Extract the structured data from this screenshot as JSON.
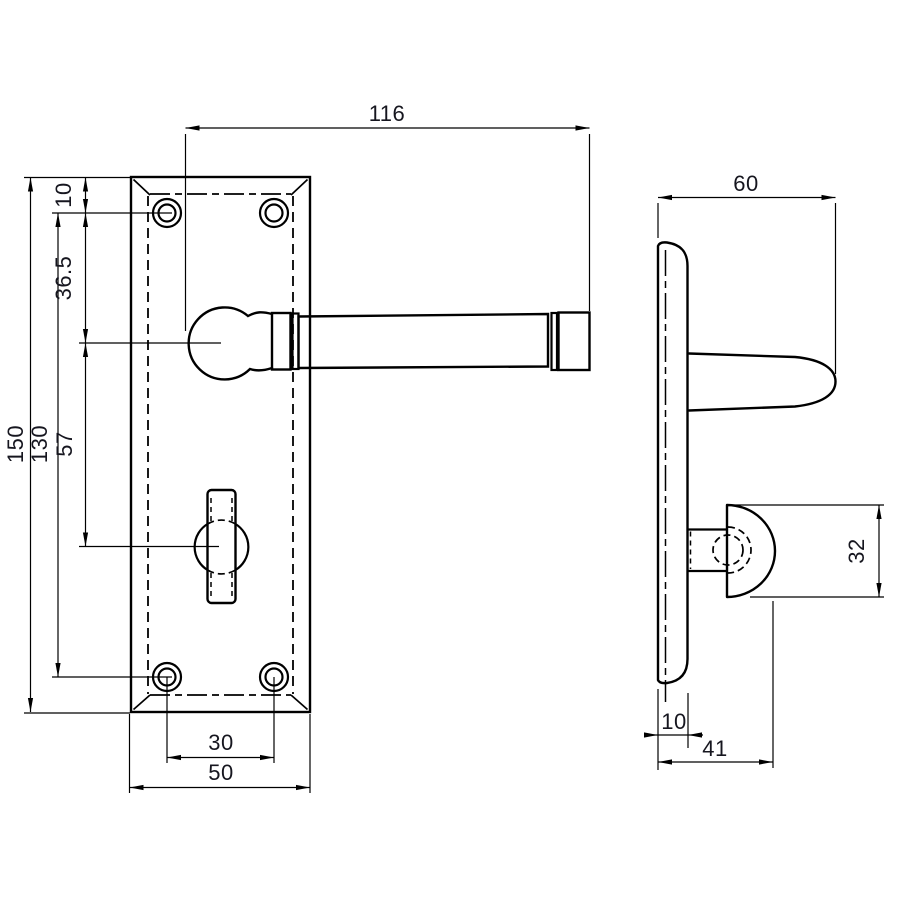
{
  "page": {
    "background": "#ffffff",
    "line_color": "#000000",
    "text_color": "#16161f",
    "description": "Technical dimension drawing of a lever door handle on backplate with thumbturn, front view and side view"
  },
  "dims": {
    "lever_length": "116",
    "plate_height": "150",
    "screw_centres_vertical": "130",
    "lever_to_thumbturn": "57",
    "screw_to_lever": "36.5",
    "top_edge_to_screw": "10",
    "screw_centres_horizontal": "30",
    "plate_width": "50",
    "overall_projection": "60",
    "thumbturn_height": "32",
    "plate_thickness": "10",
    "thumbturn_projection": "41"
  }
}
